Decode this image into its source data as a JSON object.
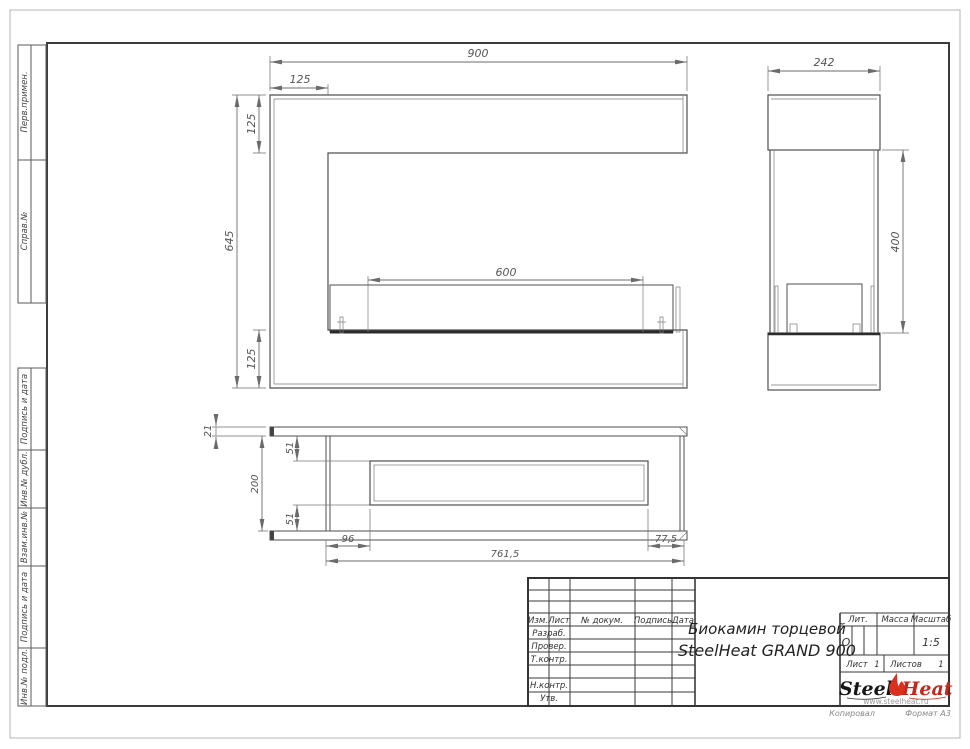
{
  "margins": {
    "perv_primen": "Перв.примен.",
    "sprav_no": "Справ.№",
    "podpis_data_1": "Подпись и дата",
    "inv_dubl": "Инв.№ дубл.",
    "vzam_inv": "Взам.инв.№",
    "podpis_data_2": "Подпись и дата",
    "inv_podl": "Инв.№ подл."
  },
  "dims": {
    "front": {
      "width": "900",
      "top_offset": "125",
      "left_top": "125",
      "height": "645",
      "left_bottom": "125",
      "burner": "600"
    },
    "side": {
      "depth": "242",
      "opening_height": "400"
    },
    "plan": {
      "flange": "21",
      "depth": "200",
      "wall_top": "51",
      "wall_bottom": "51",
      "left_offset": "96",
      "length": "761,5",
      "right_offset": "77,5"
    }
  },
  "titleblock": {
    "col_izm": "Изм.",
    "col_list": "Лист",
    "col_doc": "№ докум.",
    "col_sign": "Подпись",
    "col_date": "Дата",
    "row_razrab": "Разраб.",
    "row_prover": "Провер.",
    "row_tkontr": "Т.контр.",
    "row_nkontr": "Н.контр.",
    "row_utv": "Утв.",
    "title1": "Биокамин торцевой",
    "title2": "SteelHeat GRAND 900",
    "lit_label": "Лит.",
    "mass_label": "Масса",
    "scale_label": "Масштаб",
    "lit_value": "О",
    "scale_value": "1:5",
    "list_label": "Лист",
    "list_value": "1",
    "listov_label": "Листов",
    "listov_value": "1"
  },
  "logo": {
    "steel": "Steel",
    "heat": "Heat",
    "url": "www.steelheat.ru",
    "flame_color": "#d9301f"
  },
  "footer": {
    "kopiroval": "Копировал",
    "format": "Формат А3"
  },
  "colors": {
    "line": "#4f4f4f",
    "dim": "#6b6b6b",
    "accent_red": "#c4271b"
  }
}
